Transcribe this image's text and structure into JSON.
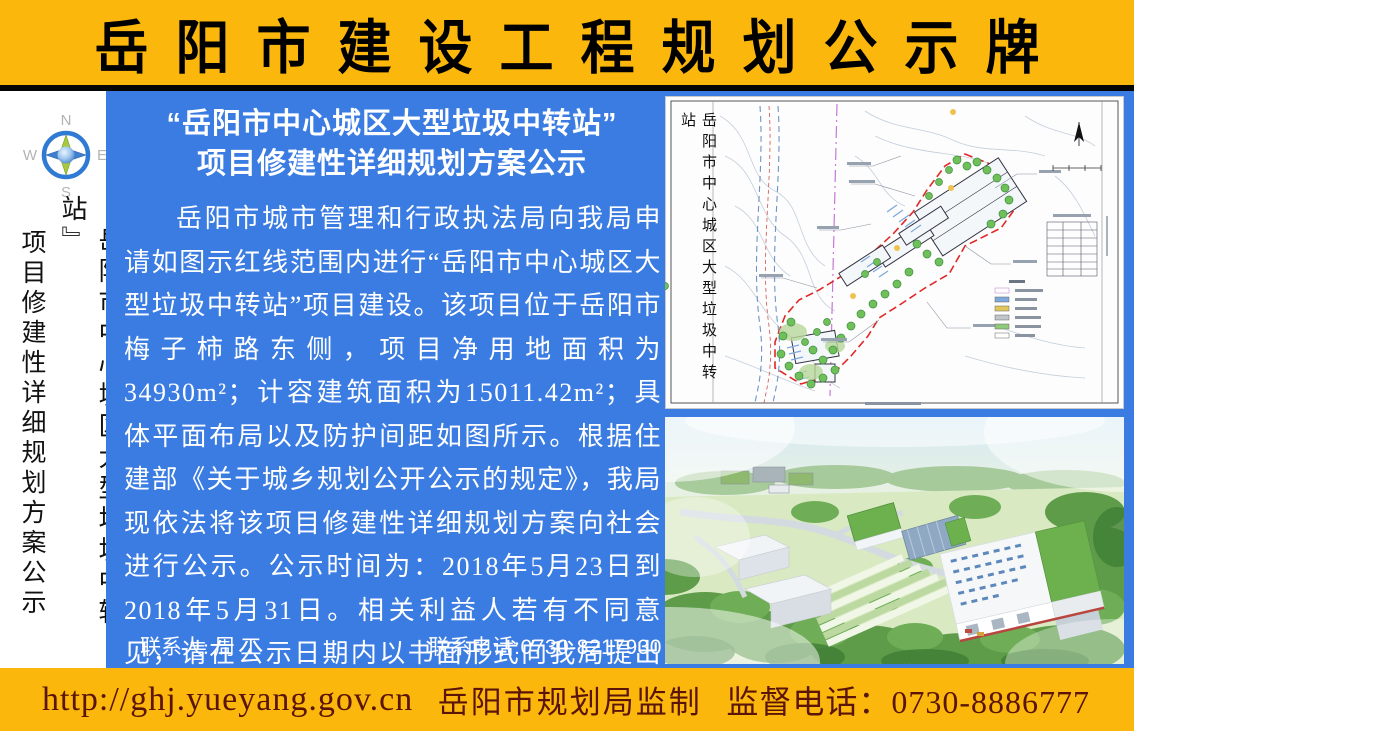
{
  "header": {
    "title": "岳阳市建设工程规划公示牌"
  },
  "sidebar": {
    "compass": {
      "north": "N",
      "east": "E",
      "south": "S",
      "west": "W"
    },
    "vertical_title_col1": "『岳阳市中心城区大型垃圾中转站』",
    "vertical_title_col2": "项目修建性详细规划方案公示"
  },
  "notice": {
    "title_line1": "“岳阳市中心城区大型垃圾中转站”",
    "title_line2": "项目修建性详细规划方案公示",
    "body": "岳阳市城市管理和行政执法局向我局申请如图示红线范围内进行“岳阳市中心城区大型垃圾中转站”项目建设。该项目位于岳阳市梅子柿路东侧，项目净用地面积为34930m²；计容建筑面积为15011.42m²；具体平面布局以及防护间距如图所示。根据住建部《关于城乡规划公开公示的规定》，我局现依法将该项目修建性详细规划方案向社会进行公示。公示时间为：2018年5月23日到2018年5月31日。相关利益人若有不同意见，请在公示日期内以书面形式向我局提出意见或建议，逾期我局不再受理。",
    "contact_person": "联系人: 周 工",
    "contact_phone": "联系电话:0730-8217930"
  },
  "site_plan": {
    "vertical_title": "岳阳市中心城区大型垃圾中转站"
  },
  "footer": {
    "url": "http://ghj.yueyang.gov.cn",
    "issuer": "岳阳市规划局监制",
    "phone": "监督电话：0730-8886777"
  },
  "colors": {
    "banner_yellow": "#FBB70B",
    "panel_blue": "#3B7CE2",
    "footer_text_red": "#5A1408",
    "site_boundary_red": "#E02828"
  }
}
